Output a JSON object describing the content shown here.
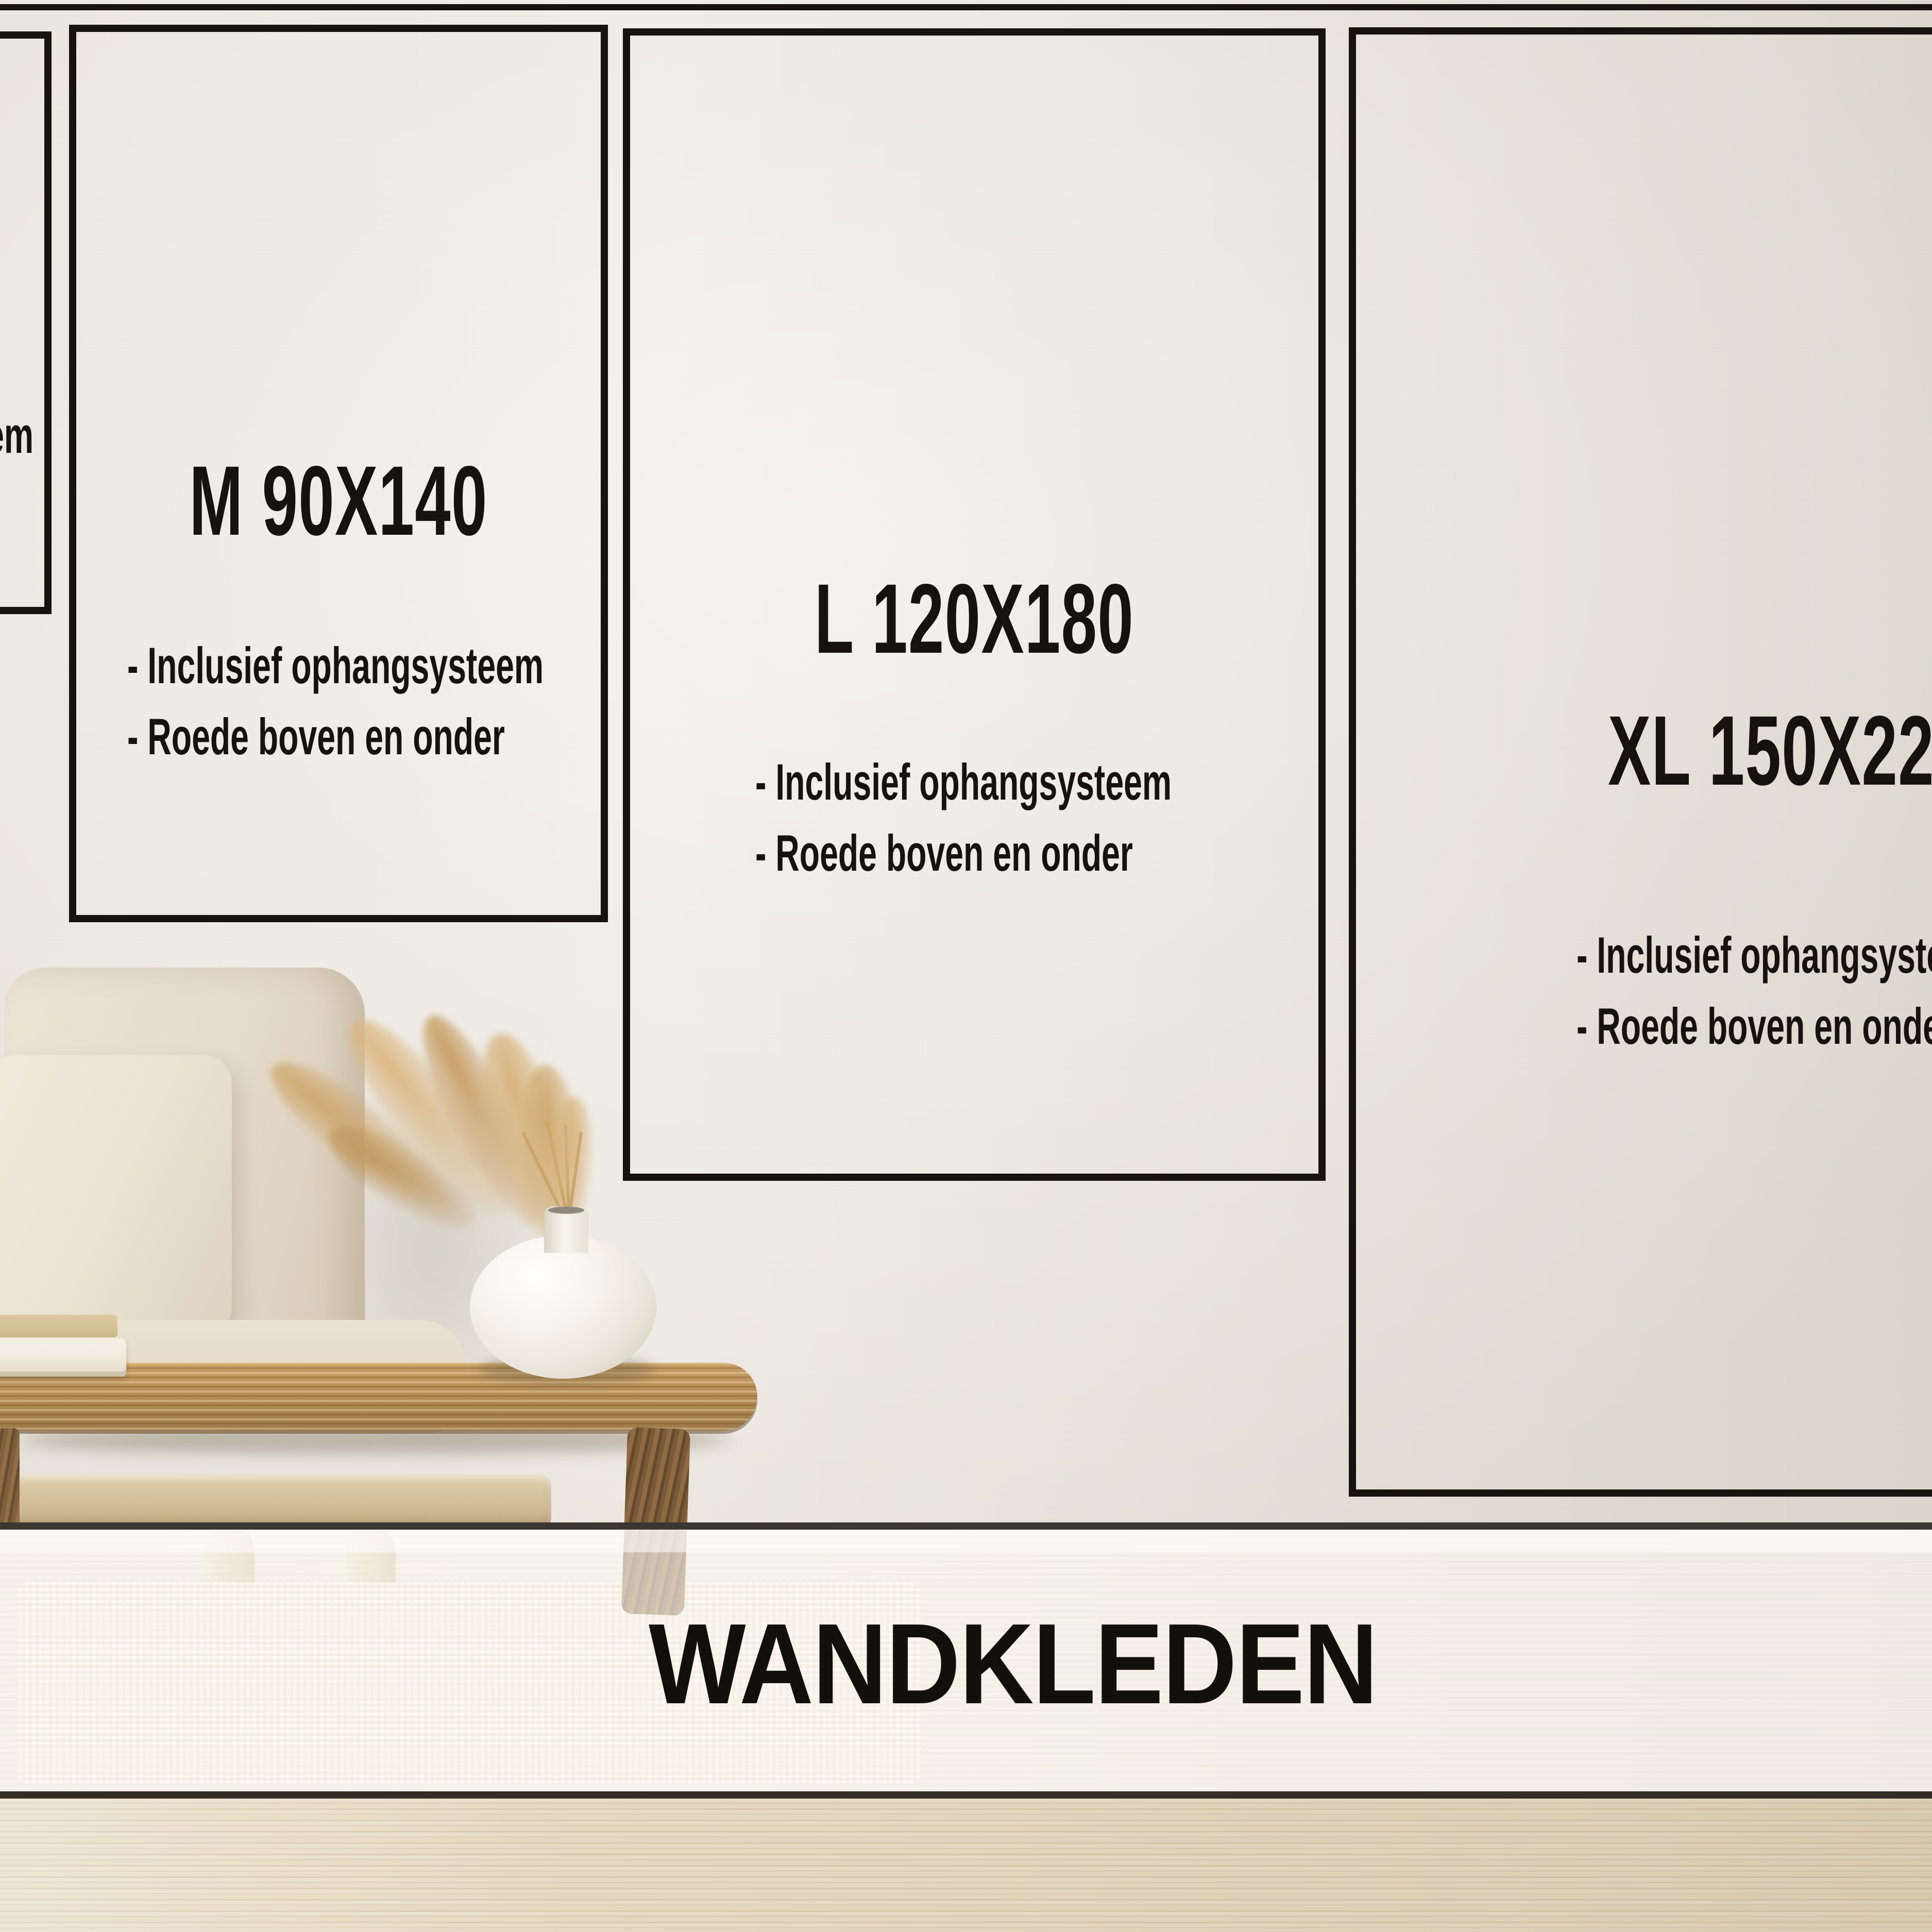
{
  "poster": {
    "footer_title": "WANDKLEDEN"
  },
  "size_boxes": [
    {
      "id": "s-partial",
      "label": "",
      "bullets": [
        "- Inclusief ophangsysteem",
        "- Roede boven en onder"
      ]
    },
    {
      "id": "m",
      "label": "M 90X140",
      "bullets": [
        "- Inclusief ophangsysteem",
        "- Roede boven en onder"
      ]
    },
    {
      "id": "l",
      "label": "L 120X180",
      "bullets": [
        "- Inclusief ophangsysteem",
        "- Roede boven en onder"
      ]
    },
    {
      "id": "xl",
      "label": "XL 150X220",
      "bullets": [
        "- Inclusief ophangsysteem",
        "- Roede boven en onder"
      ]
    }
  ],
  "colors": {
    "outline": "#171310",
    "text": "#151210",
    "wall": "#e7e2db",
    "frost_band": "#fbf8f3",
    "floor_wood": "#e2d5bf",
    "table_wood": "#b68d55",
    "couch_fabric": "#e9dfcf",
    "grass": "#cfa76f"
  }
}
